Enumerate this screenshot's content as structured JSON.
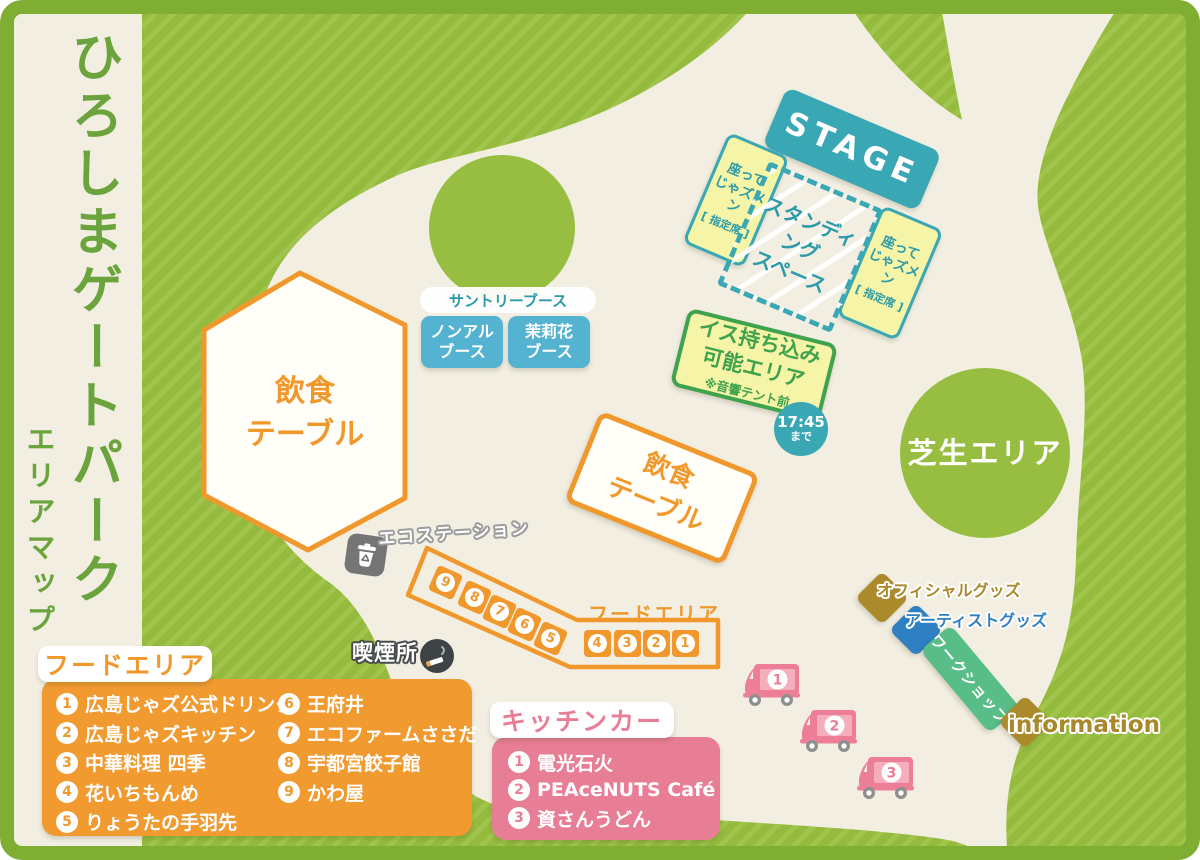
{
  "title": {
    "main": "ひろしまゲートパーク",
    "sub": "エリアマップ"
  },
  "stage": {
    "label": "STAGE"
  },
  "seating": {
    "left": {
      "line1": "座って",
      "line2": "じゃズメン",
      "line3": "[ 指定席 ]"
    },
    "right": {
      "line1": "座って",
      "line2": "じゃズメン",
      "line3": "[ 指定席 ]"
    },
    "standing": {
      "line1": "スタンディング",
      "line2": "スペース"
    },
    "chair": {
      "line1": "イス持ち込み",
      "line2": "可能エリア",
      "note": "※音響テント前"
    },
    "time_badge": {
      "time": "17:45",
      "suffix": "まで"
    }
  },
  "suntory": {
    "title": "サントリーブース",
    "booth1": {
      "line1": "ノンアル",
      "line2": "ブース"
    },
    "booth2": {
      "line1": "茉莉花",
      "line2": "ブース"
    }
  },
  "dining": {
    "hex": {
      "line1": "飲食",
      "line2": "テーブル"
    },
    "rect": {
      "line1": "飲食",
      "line2": "テーブル"
    }
  },
  "lawn": {
    "label": "芝生エリア"
  },
  "eco": {
    "label": "エコステーション"
  },
  "smoking": {
    "label": "喫煙所"
  },
  "food": {
    "map_label": "フードエリア",
    "stalls_diagonal": [
      "9",
      "8",
      "7",
      "6",
      "5"
    ],
    "stalls_row": [
      "4",
      "3",
      "2",
      "1"
    ],
    "legend_title": "フードエリア",
    "col1": [
      {
        "n": "1",
        "name": "広島じゃズ公式ドリンク"
      },
      {
        "n": "2",
        "name": "広島じゃズキッチン"
      },
      {
        "n": "3",
        "name": "中華料理 四季"
      },
      {
        "n": "4",
        "name": "花いちもんめ"
      },
      {
        "n": "5",
        "name": "りょうたの手羽先"
      }
    ],
    "col2": [
      {
        "n": "6",
        "name": "王府井"
      },
      {
        "n": "7",
        "name": "エコファームささだ"
      },
      {
        "n": "8",
        "name": "宇都宮餃子館"
      },
      {
        "n": "9",
        "name": "かわ屋"
      }
    ]
  },
  "kitchen": {
    "legend_title": "キッチンカー",
    "items": [
      {
        "n": "1",
        "name": "電光石火"
      },
      {
        "n": "2",
        "name": "PEAceNUTS Café"
      },
      {
        "n": "3",
        "name": "資さんうどん"
      }
    ],
    "trucks": [
      "1",
      "2",
      "3"
    ]
  },
  "goods": {
    "official": "オフィシャルグッズ",
    "artist": "アーティストグッズ",
    "workshop": "ワークショップ",
    "information": "information"
  },
  "colors": {
    "cream": "#f2eee2",
    "green": "#95bb3e",
    "green_stripe": "#a1c54c",
    "frame": "#7fae33",
    "title_green": "#6ba43c",
    "teal": "#3aa7b4",
    "yellow": "#f6f4a6",
    "chair_green": "#3fa24d",
    "orange": "#f0982b",
    "booth_blue": "#55b3d2",
    "pink": "#e87d96",
    "gold": "#ab8a2c",
    "goods_blue": "#2f80c3",
    "workshop_green": "#58bd86"
  }
}
